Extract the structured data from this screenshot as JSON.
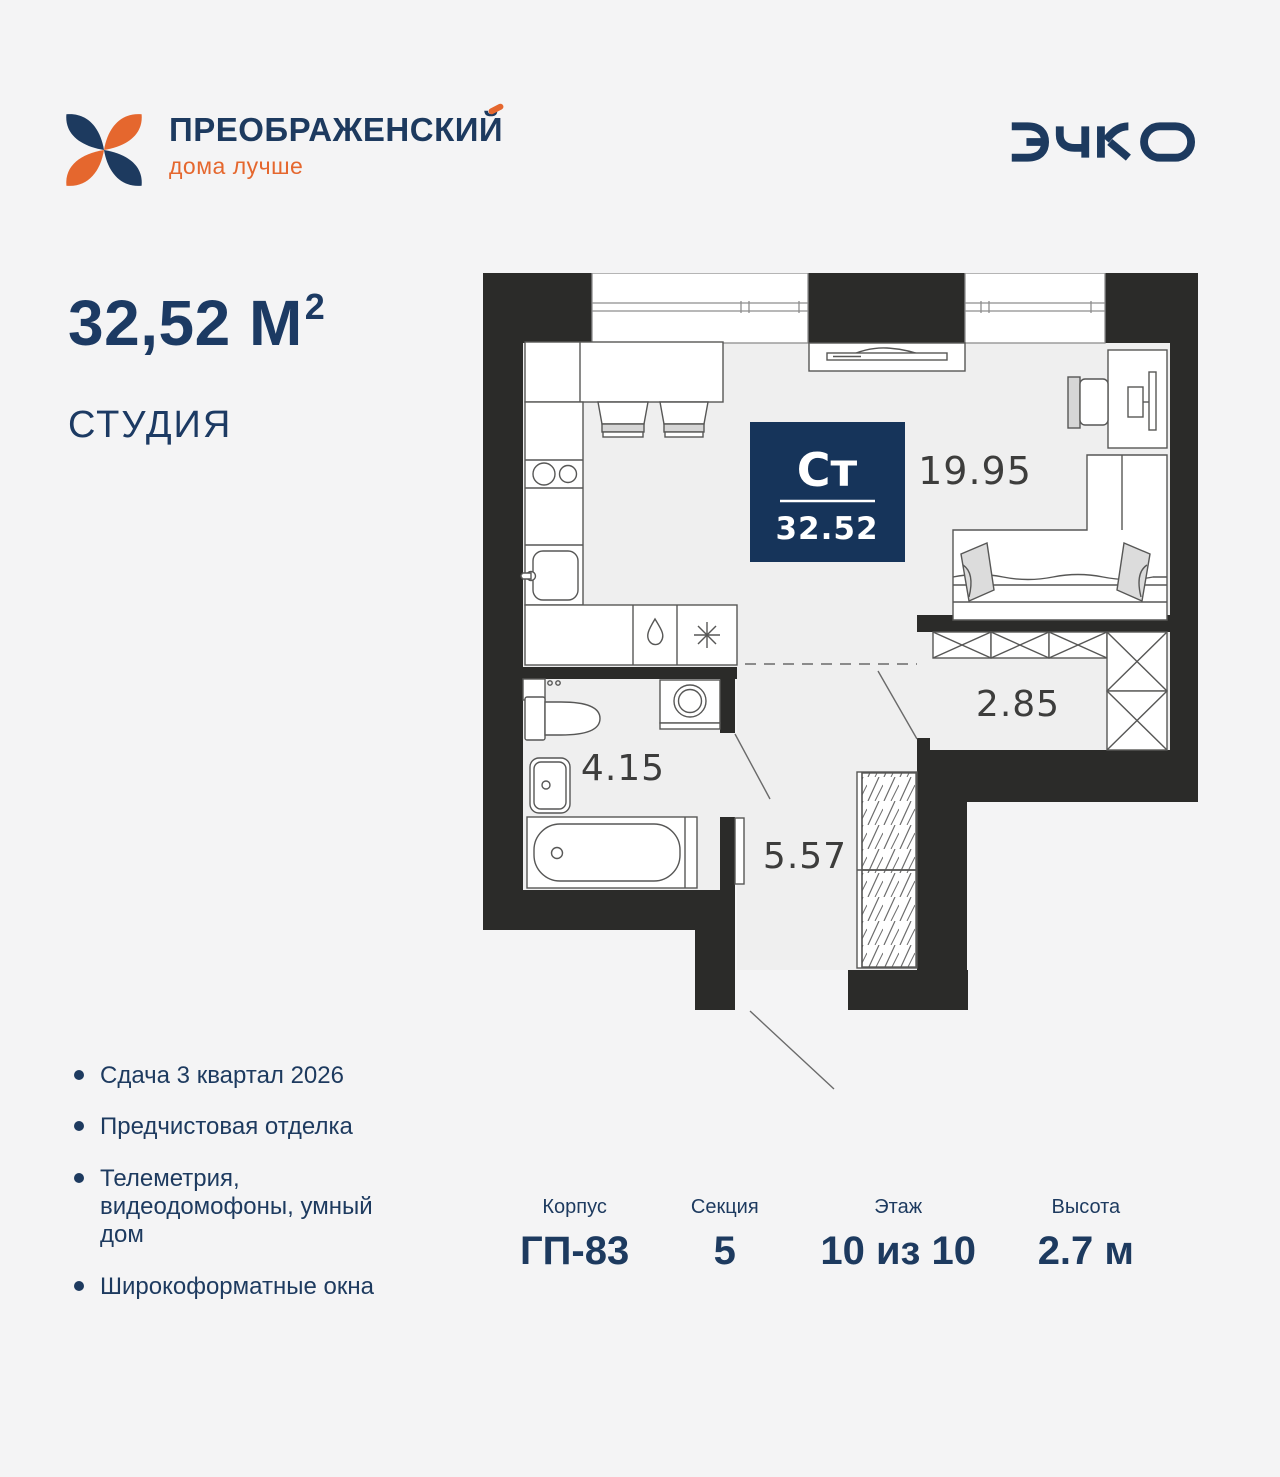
{
  "brand": {
    "name": "ПРЕОБРАЖЕНСКИЙ",
    "tagline": "дома лучше",
    "partner_logo": "ЭНКО"
  },
  "apartment": {
    "area_value": "32,52 М",
    "area_exponent": "2",
    "type_label": "СТУДИЯ"
  },
  "floorplan": {
    "badge": {
      "type_short": "Ст",
      "area": "32.52"
    },
    "rooms": {
      "living": {
        "area": "19.95"
      },
      "wardrobe": {
        "area": "2.85"
      },
      "bathroom": {
        "area": "4.15"
      },
      "hallway": {
        "area": "5.57"
      }
    }
  },
  "features": [
    "Сдача 3 квартал 2026",
    "Предчистовая отделка",
    "Телеметрия, видеодомофоны, умный дом",
    "Широкоформатные окна"
  ],
  "details": [
    {
      "label": "Корпус",
      "value": "ГП-83"
    },
    {
      "label": "Секция",
      "value": "5"
    },
    {
      "label": "Этаж",
      "value": "10 из 10"
    },
    {
      "label": "Высота",
      "value": "2.7 м"
    }
  ],
  "colors": {
    "navy": "#1d3a5f",
    "orange": "#e5672e",
    "wall": "#2b2b29",
    "floor": "#efefef",
    "badge": "#16345a",
    "background": "#f4f4f5"
  }
}
